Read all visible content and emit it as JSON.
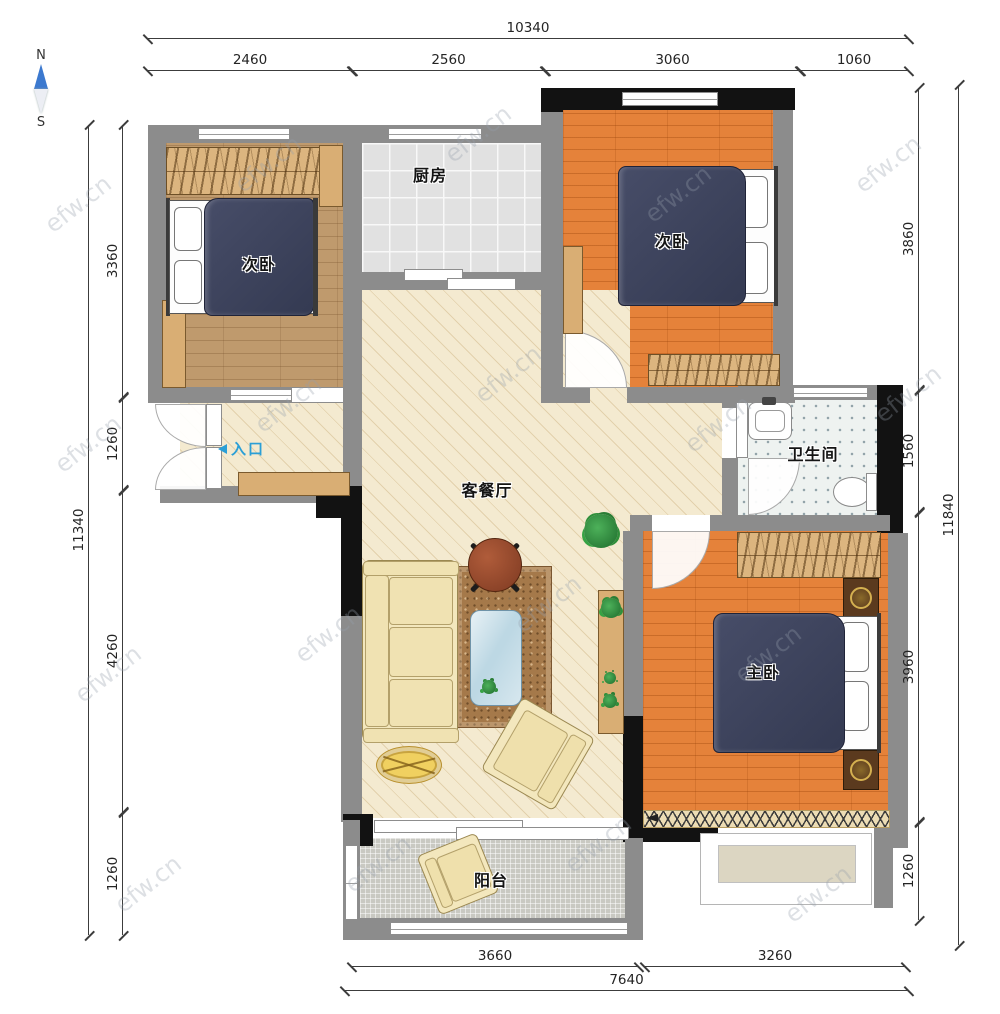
{
  "compass": {
    "north": "N",
    "south": "S"
  },
  "watermark": {
    "text": "efw.cn"
  },
  "rooms": {
    "bedroom_left": {
      "label": "次卧"
    },
    "kitchen": {
      "label": "厨房"
    },
    "bedroom_right": {
      "label": "次卧"
    },
    "bathroom": {
      "label": "卫生间"
    },
    "living_dining": {
      "label": "客餐厅"
    },
    "master_bedroom": {
      "label": "主卧"
    },
    "balcony": {
      "label": "阳台"
    },
    "entrance": {
      "label": "入口"
    }
  },
  "dimensions": {
    "top": {
      "total": "10340",
      "segments": [
        "2460",
        "2560",
        "3060",
        "1060"
      ]
    },
    "bottom": {
      "total": "7640",
      "segments": [
        "3660",
        "3260"
      ]
    },
    "left": {
      "total": "11340",
      "segments": [
        "3360",
        "1260",
        "4260",
        "1260"
      ]
    },
    "right": {
      "total": "11840",
      "segments": [
        "3860",
        "1560",
        "3960",
        "1260"
      ]
    }
  },
  "colors": {
    "wall_gray": "#8c8c8c",
    "wall_black": "#121212",
    "floor_wood": "#bf9a6d",
    "floor_orange": "#e5823a",
    "floor_cream": "#f4ead0",
    "bed_navy": "#3d4259",
    "furniture_tan": "#dcb57f",
    "entrance_blue": "#2b9fd6",
    "compass_blue": "#3c79cf"
  }
}
